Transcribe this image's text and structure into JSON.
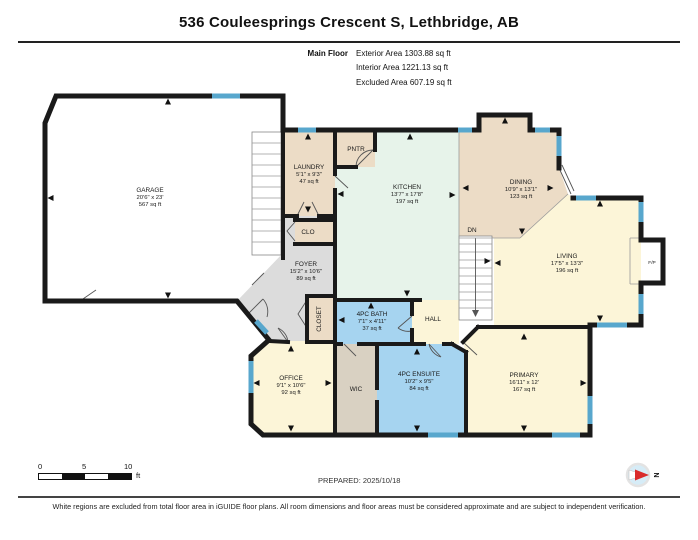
{
  "header": {
    "title": "536 Couleesprings Crescent S, Lethbridge, AB",
    "floor_label": "Main Floor",
    "stats": [
      "Exterior Area 1303.88 sq ft",
      "Interior Area 1221.13 sq ft",
      "Excluded Area 607.19 sq ft"
    ]
  },
  "rooms": {
    "garage": {
      "name": "GARAGE",
      "dims": "20'6\" x 23'",
      "area": "567 sq ft"
    },
    "laundry": {
      "name": "LAUNDRY",
      "dims": "5'1\" x 9'3\"",
      "area": "47 sq ft"
    },
    "pantry": {
      "name": "PNTR"
    },
    "clo": {
      "name": "CLO"
    },
    "closet": {
      "name": "CLOSET"
    },
    "kitchen": {
      "name": "KITCHEN",
      "dims": "13'7\" x 17'8\"",
      "area": "197 sq ft"
    },
    "dining": {
      "name": "DINING",
      "dims": "10'9\" x 13'1\"",
      "area": "123 sq ft"
    },
    "living": {
      "name": "LIVING",
      "dims": "17'5\" x 13'3\"",
      "area": "196 sq ft"
    },
    "foyer": {
      "name": "FOYER",
      "dims": "15'2\" x 10'6\"",
      "area": "89 sq ft"
    },
    "bath": {
      "name": "4PC BATH",
      "dims": "7'1\" x 4'11\"",
      "area": "37 sq ft"
    },
    "hall": {
      "name": "HALL"
    },
    "office": {
      "name": "OFFICE",
      "dims": "9'1\" x 10'6\"",
      "area": "92 sq ft"
    },
    "wic": {
      "name": "WIC"
    },
    "ensuite": {
      "name": "4PC ENSUITE",
      "dims": "10'2\" x 9'5\"",
      "area": "84 sq ft"
    },
    "primary": {
      "name": "PRIMARY",
      "dims": "16'11\" x 12'",
      "area": "167 sq ft"
    },
    "stairs": {
      "label": "DN"
    },
    "fireplace": {
      "label": "F/P"
    }
  },
  "scale_bar": {
    "ticks": [
      "0",
      "5",
      "10"
    ],
    "unit": "ft"
  },
  "prepared": "PREPARED: 2025/10/18",
  "compass": {
    "label": "N"
  },
  "disclaimer": "White regions are excluded from total floor area in iGUIDE floor plans. All room dimensions and floor areas must be considered approximate and are subject to independent verification.",
  "colors": {
    "wall": "#1a1a1a",
    "window": "#58a7cd",
    "room_tan": "#ecdcc6",
    "room_mint": "#e7f3ea",
    "room_cream": "#fcf5d8",
    "room_blue": "#a6d4f0",
    "room_gray": "#dcdcdc",
    "room_wic": "#d9d1c2",
    "excluded_white": "#ffffff",
    "compass_red": "#d92b2b"
  }
}
